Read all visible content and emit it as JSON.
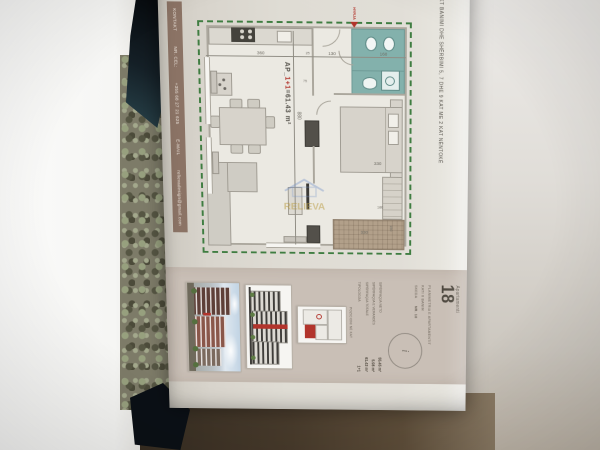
{
  "sheet": {
    "project_title": "OBJEKT BANIMI DHE SHËRBIMI 5, 7 DHE 9 KAT ME 2 KAT NËNTOKË",
    "contact": {
      "label": "KONTAKT",
      "phone_label": "NR. CEL:",
      "phone": "+355 68 27 21 625",
      "email_label": "E-MAIL",
      "email": "relievadesign@gmail.com"
    }
  },
  "plan": {
    "unit_prefix": "AP_",
    "unit_type": "1+1",
    "unit_area": "=61.43 m²",
    "entrance_label": "HYRJA",
    "watermark": "RELIEVA",
    "dims": {
      "bath_depth": "160",
      "hall_depth": "130",
      "wall": "25",
      "living_depth": "360",
      "total_width": "880",
      "bed_width": "330",
      "wardrobe_width": "180",
      "veranda_length": "330",
      "veranda_width": "150",
      "small_wall": "75"
    }
  },
  "panel": {
    "apartment_word": "Apartamenti",
    "apartment_number": "18",
    "subtitle1": "PLANIMETRIA E APARTAMENTIT",
    "subtitle2": "KATI II BANIM",
    "sheet_label": "SKEDA",
    "sheet_no": "NR. 18",
    "info_glyph": "i",
    "areas": [
      {
        "label": "SIPËRFAQJA NETO",
        "value": "55.45 m²"
      },
      {
        "label": "SIPËRFAQJA E VERANDËS",
        "value": "5.98 m²"
      },
      {
        "label": "SIPËRFAQJA TOTALE",
        "value": "61.43 m²"
      }
    ],
    "typology_label": "TIPOLOGJIA",
    "typology_value": "1+1",
    "keyplan_caption": "POZICIONI NË KAT"
  },
  "colors": {
    "dashed_border": "#3f7d41",
    "accent_red": "#b2342c",
    "bath_teal": "#83b1ac",
    "veranda_tan": "#b2a08a",
    "contact_bar": "#8b7365",
    "panel_bg": "#c9bfb6"
  }
}
